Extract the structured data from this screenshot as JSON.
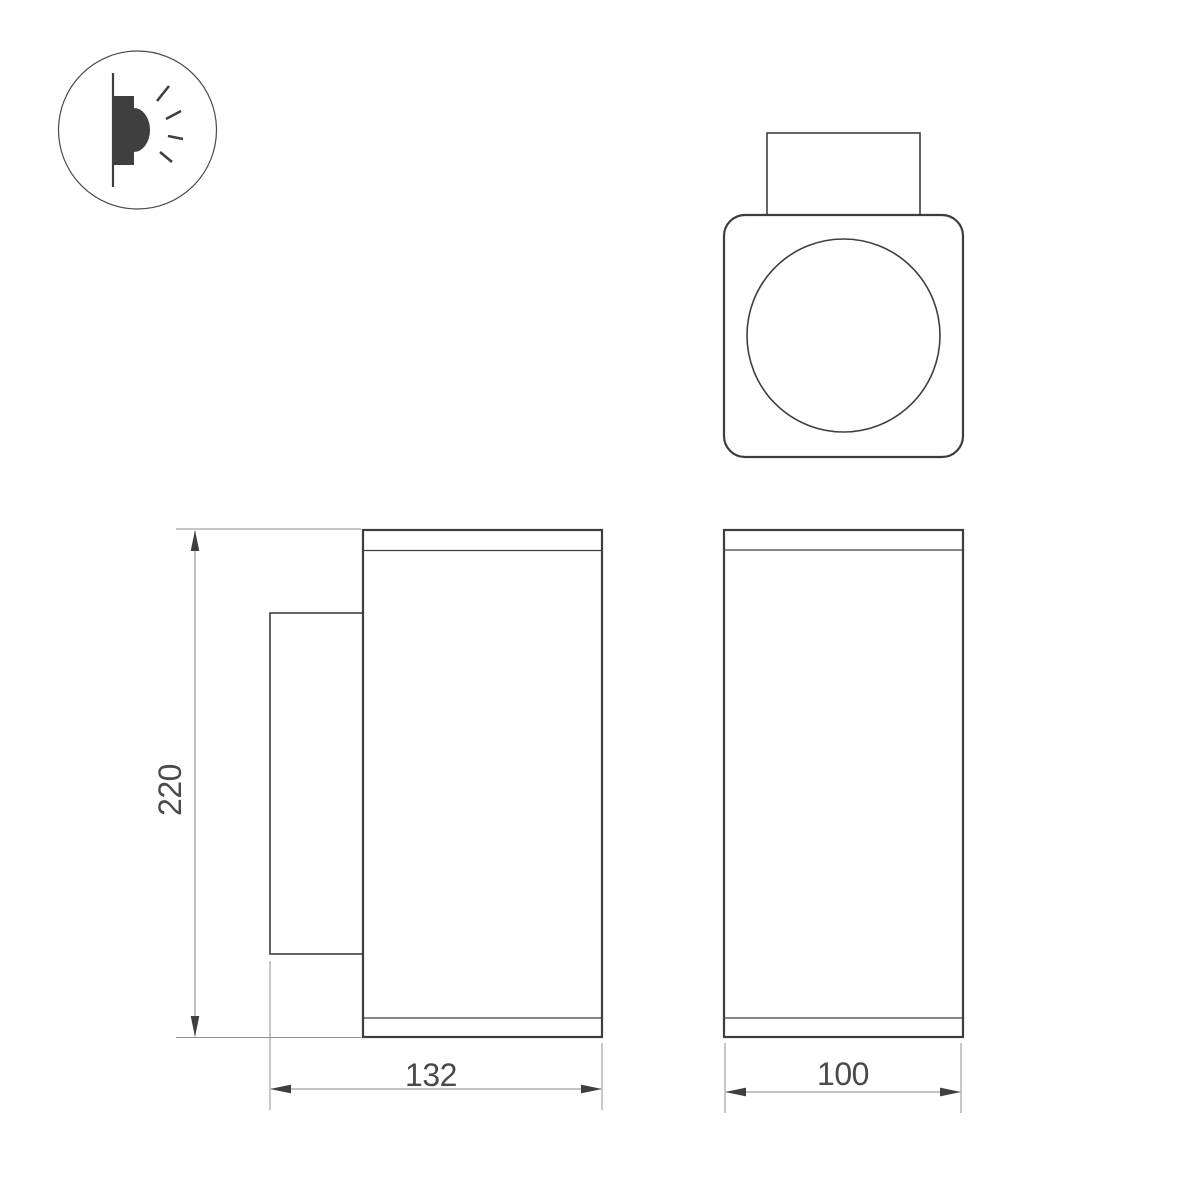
{
  "page": {
    "background_color": "#ffffff"
  },
  "drawing": {
    "type": "technical-dimension-drawing",
    "colors": {
      "outline": "#3d3d3d",
      "dimension_lines": "#8a8a8a",
      "dimension_text": "#4a4a4a"
    },
    "icon": {
      "name": "wall-light-emission-icon"
    },
    "dimensions": {
      "height": {
        "label": "220"
      },
      "depth": {
        "label": "132"
      },
      "width": {
        "label": "100"
      }
    }
  }
}
